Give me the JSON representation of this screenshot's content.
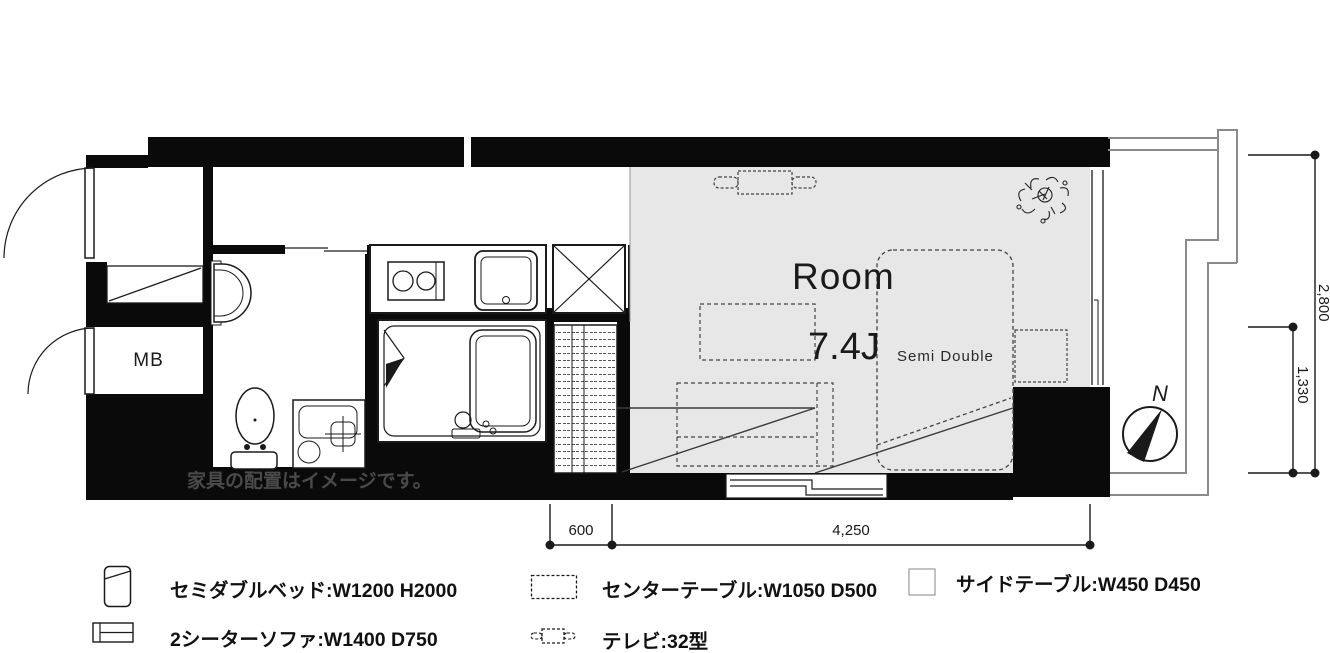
{
  "plan": {
    "room_name": "Room",
    "room_size": "7.4J",
    "bed_label": "Semi Double",
    "meter_box_label": "MB",
    "compass_north": "N",
    "watermark": "家具の配置はイメージです。"
  },
  "dimensions": {
    "entry_width": "600",
    "room_width": "4,250",
    "room_depth": "2,800",
    "balcony_depth": "1,330"
  },
  "legend": {
    "items": [
      {
        "icon": "bed-icon",
        "label": "セミダブルベッド:W1200 H2000"
      },
      {
        "icon": "center-table-icon",
        "label": "センターテーブル:W1050 D500"
      },
      {
        "icon": "side-table-icon",
        "label": "サイドテーブル:W450 D450"
      },
      {
        "icon": "sofa-icon",
        "label": "2シーターソファ:W1400 D750"
      },
      {
        "icon": "tv-icon",
        "label": "テレビ:32型"
      }
    ]
  },
  "colors": {
    "wall": "#0a0a0a",
    "room_floor": "#e7e7e7",
    "line": "#1a1a1a",
    "balcony_line": "#8a8a8a",
    "furniture_dash": "#444444"
  }
}
